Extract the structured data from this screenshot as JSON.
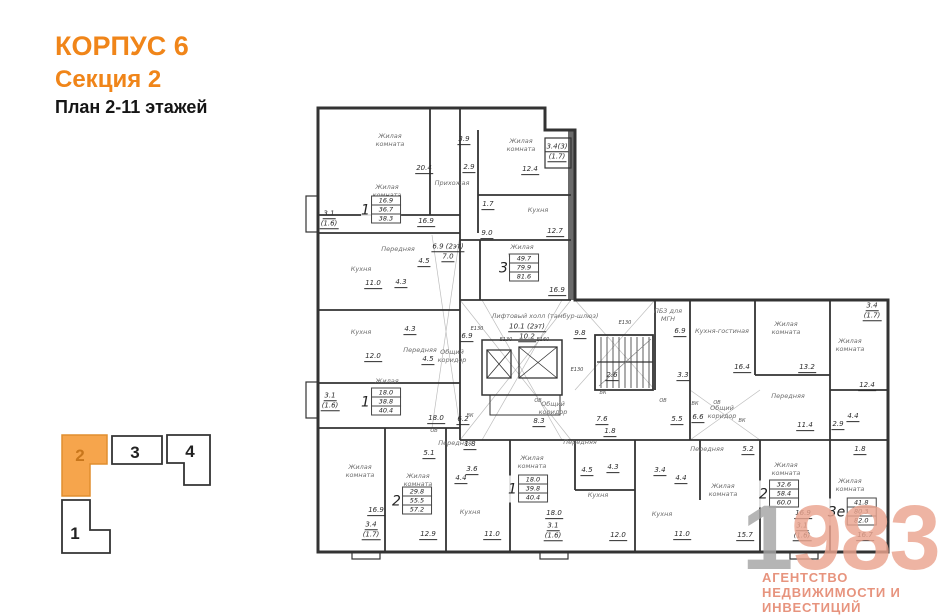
{
  "header": {
    "building": "КОРПУС 6",
    "section": "Секция 2",
    "plan": "План 2-11 этажей"
  },
  "keyplan": {
    "sections": [
      {
        "label": "2",
        "active": true
      },
      {
        "label": "3",
        "active": false
      },
      {
        "label": "4",
        "active": false
      },
      {
        "label": "1",
        "active": false
      }
    ]
  },
  "colors": {
    "accent": "#F08519",
    "keyplan_active_fill": "#F6A54C",
    "watermark_number": "#EBA48F",
    "watermark_gray": "#A5A5A5",
    "watermark_text": "#E58B74",
    "wall": "#333333"
  },
  "watermark": {
    "prefix": "1",
    "suffix": "983",
    "line1": "АГЕНТСТВО",
    "line2": "НЕДВИЖИМОСТИ И ИНВЕСТИЦИЙ"
  },
  "plan": {
    "room_labels": [
      {
        "lines": [
          "Жилая",
          "комната"
        ],
        "x": 390,
        "y": 141
      },
      {
        "lines": [
          "Жилая",
          "комната"
        ],
        "x": 387,
        "y": 192
      },
      {
        "lines": [
          "Прихожая"
        ],
        "x": 452,
        "y": 184
      },
      {
        "lines": [
          "Жилая",
          "комната"
        ],
        "x": 521,
        "y": 146
      },
      {
        "lines": [
          "Кухня"
        ],
        "x": 538,
        "y": 211
      },
      {
        "lines": [
          "Передняя"
        ],
        "x": 398,
        "y": 250
      },
      {
        "lines": [
          "Кухня"
        ],
        "x": 361,
        "y": 270
      },
      {
        "lines": [
          "Кухня"
        ],
        "x": 361,
        "y": 333
      },
      {
        "lines": [
          "Передняя"
        ],
        "x": 420,
        "y": 351
      },
      {
        "lines": [
          "Жилая",
          "комната"
        ],
        "x": 522,
        "y": 252
      },
      {
        "lines": [
          "Жилая",
          "комната"
        ],
        "x": 387,
        "y": 386
      },
      {
        "lines": [
          "Лифтовый холл (тамбур-шлюз)"
        ],
        "x": 545,
        "y": 317
      },
      {
        "lines": [
          "Общий",
          "коридор"
        ],
        "x": 452,
        "y": 357
      },
      {
        "lines": [
          "Общий",
          "коридор"
        ],
        "x": 553,
        "y": 409
      },
      {
        "lines": [
          "Общий",
          "коридор"
        ],
        "x": 722,
        "y": 413
      },
      {
        "lines": [
          "ПБ3 для",
          "МГН"
        ],
        "x": 668,
        "y": 316
      },
      {
        "lines": [
          "Кухня-гостиная"
        ],
        "x": 722,
        "y": 332
      },
      {
        "lines": [
          "Жилая",
          "комната"
        ],
        "x": 786,
        "y": 329
      },
      {
        "lines": [
          "Жилая",
          "комната"
        ],
        "x": 850,
        "y": 346
      },
      {
        "lines": [
          "Передняя"
        ],
        "x": 788,
        "y": 397
      },
      {
        "lines": [
          "Жилая",
          "комната"
        ],
        "x": 360,
        "y": 472
      },
      {
        "lines": [
          "Жилая",
          "комната"
        ],
        "x": 418,
        "y": 481
      },
      {
        "lines": [
          "Передняя"
        ],
        "x": 455,
        "y": 444
      },
      {
        "lines": [
          "Кухня"
        ],
        "x": 470,
        "y": 513
      },
      {
        "lines": [
          "Жилая",
          "комната"
        ],
        "x": 532,
        "y": 463
      },
      {
        "lines": [
          "Передняя"
        ],
        "x": 580,
        "y": 443
      },
      {
        "lines": [
          "Кухня"
        ],
        "x": 598,
        "y": 496
      },
      {
        "lines": [
          "Кухня"
        ],
        "x": 662,
        "y": 515
      },
      {
        "lines": [
          "Передняя"
        ],
        "x": 707,
        "y": 450
      },
      {
        "lines": [
          "Жилая",
          "комната"
        ],
        "x": 723,
        "y": 491
      },
      {
        "lines": [
          "Жилая",
          "комната"
        ],
        "x": 786,
        "y": 470
      },
      {
        "lines": [
          "Жилая",
          "комната"
        ],
        "x": 850,
        "y": 486
      }
    ],
    "dims": [
      {
        "v": "20.4",
        "x": 424,
        "y": 169
      },
      {
        "v": "16.9",
        "x": 426,
        "y": 222
      },
      {
        "v": "3.9",
        "x": 464,
        "y": 140
      },
      {
        "v": "2.9",
        "x": 469,
        "y": 168
      },
      {
        "v": "12.4",
        "x": 530,
        "y": 170
      },
      {
        "v": "3.4(3)",
        "s": "(1.7)",
        "x": 557,
        "y": 152
      },
      {
        "v": "1.7",
        "x": 488,
        "y": 205
      },
      {
        "v": "12.7",
        "x": 555,
        "y": 232
      },
      {
        "v": "9.0",
        "x": 487,
        "y": 234
      },
      {
        "v": "16.9",
        "x": 557,
        "y": 291
      },
      {
        "v": "3.1",
        "s": "(1.6)",
        "x": 329,
        "y": 219
      },
      {
        "v": "11.0",
        "x": 373,
        "y": 284
      },
      {
        "v": "4.5",
        "x": 424,
        "y": 262
      },
      {
        "v": "4.3",
        "x": 401,
        "y": 283
      },
      {
        "v": "6.9 (2эт)",
        "s": "7.0",
        "x": 448,
        "y": 252
      },
      {
        "v": "4.3",
        "x": 410,
        "y": 330
      },
      {
        "v": "12.0",
        "x": 373,
        "y": 357
      },
      {
        "v": "4.5",
        "x": 428,
        "y": 360
      },
      {
        "v": "3.1",
        "s": "(1.6)",
        "x": 330,
        "y": 401
      },
      {
        "v": "18.0",
        "x": 436,
        "y": 419
      },
      {
        "v": "6.2",
        "x": 463,
        "y": 420
      },
      {
        "v": "10.1 (2эт)",
        "s": "10.2",
        "x": 527,
        "y": 332
      },
      {
        "v": "9.8",
        "x": 580,
        "y": 334
      },
      {
        "v": "6.9",
        "x": 467,
        "y": 337
      },
      {
        "v": "2.6",
        "x": 612,
        "y": 376
      },
      {
        "v": "3.3",
        "x": 683,
        "y": 376
      },
      {
        "v": "6.9",
        "x": 680,
        "y": 332
      },
      {
        "v": "16.4",
        "x": 742,
        "y": 368
      },
      {
        "v": "13.2",
        "x": 807,
        "y": 368
      },
      {
        "v": "11.4",
        "x": 805,
        "y": 426
      },
      {
        "v": "12.4",
        "x": 867,
        "y": 386
      },
      {
        "v": "3.4",
        "s": "(1.7)",
        "x": 872,
        "y": 311
      },
      {
        "v": "5.5",
        "x": 677,
        "y": 420
      },
      {
        "v": "6.6",
        "x": 698,
        "y": 418
      },
      {
        "v": "8.3",
        "x": 539,
        "y": 422
      },
      {
        "v": "7.6",
        "x": 602,
        "y": 420
      },
      {
        "v": "1.8",
        "x": 470,
        "y": 445
      },
      {
        "v": "5.1",
        "x": 429,
        "y": 454
      },
      {
        "v": "3.6",
        "x": 472,
        "y": 470
      },
      {
        "v": "4.4",
        "x": 461,
        "y": 479
      },
      {
        "v": "16.9",
        "x": 376,
        "y": 511
      },
      {
        "v": "3.4",
        "s": "(1.7)",
        "x": 371,
        "y": 530
      },
      {
        "v": "12.9",
        "x": 428,
        "y": 535
      },
      {
        "v": "11.0",
        "x": 492,
        "y": 535
      },
      {
        "v": "4.5",
        "x": 587,
        "y": 471
      },
      {
        "v": "4.3",
        "x": 613,
        "y": 468
      },
      {
        "v": "1.8",
        "x": 610,
        "y": 432
      },
      {
        "v": "18.0",
        "x": 554,
        "y": 514
      },
      {
        "v": "3.1",
        "s": "(1.6)",
        "x": 553,
        "y": 531
      },
      {
        "v": "12.0",
        "x": 618,
        "y": 536
      },
      {
        "v": "3.4",
        "x": 660,
        "y": 471
      },
      {
        "v": "4.4",
        "x": 681,
        "y": 479
      },
      {
        "v": "11.0",
        "x": 682,
        "y": 535
      },
      {
        "v": "5.2",
        "x": 748,
        "y": 450
      },
      {
        "v": "15.7",
        "x": 745,
        "y": 536
      },
      {
        "v": "2.9",
        "x": 838,
        "y": 425
      },
      {
        "v": "4.4",
        "x": 853,
        "y": 417
      },
      {
        "v": "1.8",
        "x": 860,
        "y": 450
      },
      {
        "v": "16.9",
        "x": 803,
        "y": 514
      },
      {
        "v": "3.1",
        "s": "(1.6)",
        "x": 802,
        "y": 531
      },
      {
        "v": "16.7",
        "x": 865,
        "y": 536
      }
    ],
    "vents": [
      {
        "t": "ВК",
        "x": 470,
        "y": 416
      },
      {
        "t": "ОВ",
        "x": 538,
        "y": 401
      },
      {
        "t": "ВК",
        "x": 603,
        "y": 393
      },
      {
        "t": "ОВ",
        "x": 663,
        "y": 401
      },
      {
        "t": "ВК",
        "x": 695,
        "y": 404
      },
      {
        "t": "ОВ",
        "x": 717,
        "y": 403
      },
      {
        "t": "ВК",
        "x": 742,
        "y": 421
      },
      {
        "t": "ОВ",
        "x": 434,
        "y": 431
      }
    ],
    "lifts": [
      {
        "t": "Е130",
        "x": 477,
        "y": 329
      },
      {
        "t": "Е130",
        "x": 506,
        "y": 340
      },
      {
        "t": "Е160",
        "x": 543,
        "y": 340
      },
      {
        "t": "Е130",
        "x": 577,
        "y": 370
      },
      {
        "t": "Е130",
        "x": 625,
        "y": 323
      }
    ],
    "apartments": [
      {
        "num": "1",
        "values": [
          "16.9",
          "36.7",
          "38.3"
        ],
        "x": 381,
        "y": 210
      },
      {
        "num": "3",
        "values": [
          "49.7",
          "79.9",
          "81.6"
        ],
        "x": 519,
        "y": 268
      },
      {
        "num": "1",
        "values": [
          "18.0",
          "38.8",
          "40.4"
        ],
        "x": 381,
        "y": 402
      },
      {
        "num": "2",
        "values": [
          "29.8",
          "55.5",
          "57.2"
        ],
        "x": 412,
        "y": 501
      },
      {
        "num": "1",
        "values": [
          "18.0",
          "39.8",
          "40.4"
        ],
        "x": 528,
        "y": 489
      },
      {
        "num": "2",
        "values": [
          "32.6",
          "58.4",
          "60.0"
        ],
        "x": 779,
        "y": 494
      },
      {
        "num": "3е",
        "values": [
          "41.8",
          "80.3",
          "82.0"
        ],
        "x": 852,
        "y": 512
      }
    ]
  }
}
